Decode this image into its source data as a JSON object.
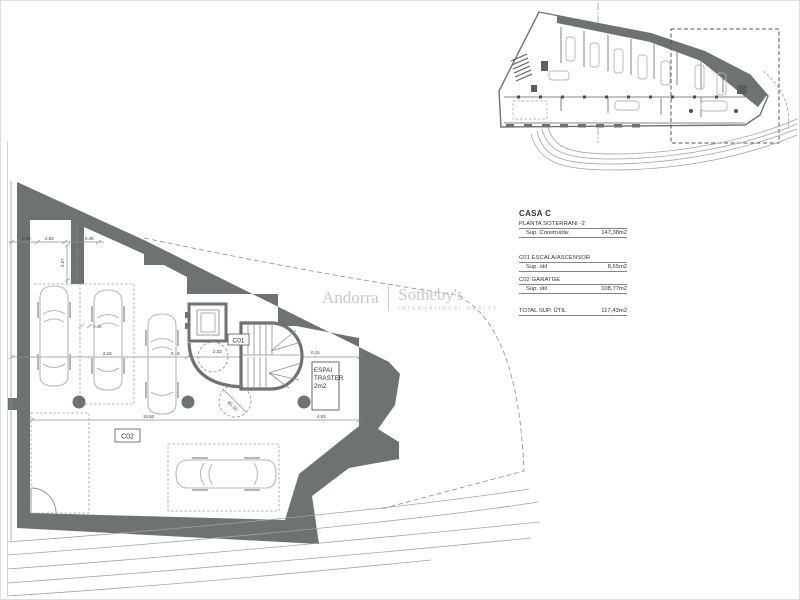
{
  "watermark": {
    "brand_left": "Andorra",
    "brand_right": "Sotheby's",
    "subtitle": "INTERNATIONAL REALTY"
  },
  "summary": {
    "title": "CASA C",
    "floor_line": "PLANTA SOTERRANI -2",
    "built_label": "Sup. Construïda:",
    "built_value": "147,38m2",
    "rooms": [
      {
        "code_line": "C01 ESCALA/ASCENSOR",
        "label": "Sup. útil",
        "value": "8,65m2"
      },
      {
        "code_line": "C02 GARATGE",
        "label": "Sup. útil",
        "value": "108,77m2"
      }
    ],
    "total_label": "TOTAL SUP. ÚTIL",
    "total_value": "117,43m2"
  },
  "plan": {
    "core_label": "C01",
    "garage_label": "C02",
    "storage_line1": "ESPAI",
    "storage_line2": "TRASTER",
    "storage_line3": "2m2",
    "dims": {
      "a": "0.20",
      "b": "2.83",
      "c": "0.45",
      "d": "2.57",
      "e": "0.46",
      "f": "2.18",
      "g": "0.18",
      "h": "2.33",
      "i": "0.15",
      "j": "0.15",
      "k": "0.15",
      "l": "Ø1.50",
      "m": "10.93",
      "n": "4.93"
    }
  }
}
